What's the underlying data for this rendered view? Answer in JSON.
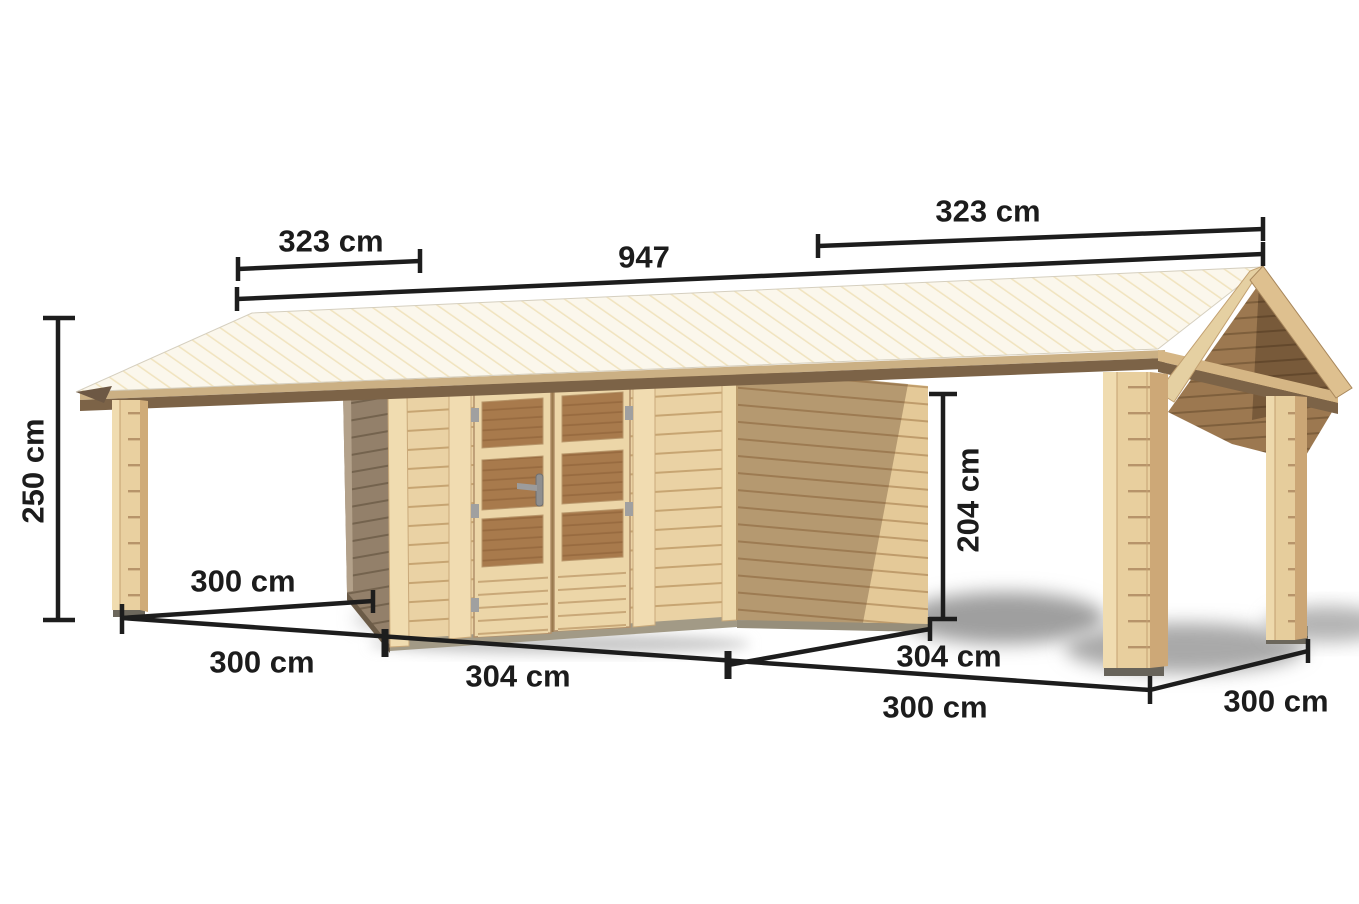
{
  "figure": {
    "title": "Wooden garden shed with two carport extensions - dimensioned product drawing",
    "background": "#ffffff",
    "dimension_line_color": "#1d1d1d",
    "wood_light": "#ead2a4",
    "wood_mid": "#d7b888",
    "wood_dark": "#7c6347",
    "roof_color": "#fbf7ec",
    "window_color": "#a87a4c",
    "shadow_color": "#a8a8a8"
  },
  "dimensions": {
    "roof_left_span": "323 cm",
    "roof_total_span": "947",
    "roof_right_span": "323 cm",
    "outer_height": "250 cm",
    "clearance_height": "204 cm",
    "left_carport_depth": "300 cm",
    "left_carport_width": "300 cm",
    "shed_front_width": "304 cm",
    "shed_depth": "304 cm",
    "right_carport_width": "300 cm",
    "right_carport_depth": "300 cm"
  }
}
